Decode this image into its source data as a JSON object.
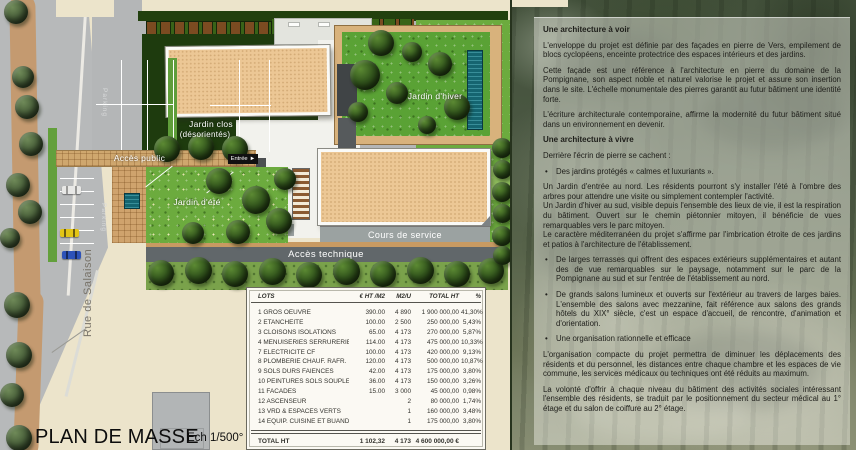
{
  "plan": {
    "title": "PLAN DE MASSE",
    "scale": "Ech 1/500°",
    "street": "Rue de Salaison",
    "labels": {
      "parking": "Parking",
      "acces_public": "Accès public",
      "entree": "Entrée",
      "jardin_clos_line1": "Jardin clos",
      "jardin_clos_line2": "(désorientés)",
      "jardin_hiver": "Jardin d'hiver",
      "jardin_ete": "Jardin d'été",
      "cours_service": "Cours de service",
      "acces_technique": "Accès technique"
    }
  },
  "icons": {
    "entree_arrow": "►",
    "bullet": "•"
  },
  "table": {
    "headers": [
      "LOTS",
      "€ HT /M2",
      "M2/U",
      "TOTAL HT",
      "%"
    ],
    "rows": [
      [
        "1 GROS OEUVRE",
        "390.00",
        "4 890",
        "1 900 000,00",
        "41,30%"
      ],
      [
        "2 ETANCHEITE",
        "100.00",
        "2 500",
        "250 000,00",
        "5,43%"
      ],
      [
        "3 CLOISONS ISOLATIONS",
        "65.00",
        "4 173",
        "270 000,00",
        "5,87%"
      ],
      [
        "4 MENUISERIES SERRURERIE",
        "114.00",
        "4 173",
        "475 000,00",
        "10,33%"
      ],
      [
        "7 ELECTRICITE CF",
        "100.00",
        "4 173",
        "420 000,00",
        "9,13%"
      ],
      [
        "8 PLOMBERIE CHAUF. RAFR.",
        "120.00",
        "4 173",
        "500 000,00",
        "10,87%"
      ],
      [
        "9 SOLS DURS FAIENCES",
        "42.00",
        "4 173",
        "175 000,00",
        "3,80%"
      ],
      [
        "10 PEINTURES SOLS SOUPLES",
        "36.00",
        "4 173",
        "150 000,00",
        "3,26%"
      ],
      [
        "11 FACADES",
        "15.00",
        "3 000",
        "45 000,00",
        "0,98%"
      ],
      [
        "12 ASCENSEUR",
        "",
        "2",
        "80 000,00",
        "1,74%"
      ],
      [
        "13 VRD & ESPACES VERTS",
        "",
        "1",
        "160 000,00",
        "3,48%"
      ],
      [
        "14 EQUIP. CUISINE ET BUANDERIE",
        "",
        "1",
        "175 000,00",
        "3,80%"
      ]
    ],
    "total": [
      "TOTAL HT",
      "1 102,32",
      "4 173",
      "4 600 000,00 €",
      ""
    ]
  },
  "panel": {
    "sections": [
      {
        "type": "heading",
        "text": "Une architecture à voir"
      },
      {
        "type": "para",
        "text": "L'enveloppe du projet est définie par des façades en pierre de Vers, empilement de blocs cyclopéens, enceinte protectrice des espaces intérieurs et des jardins."
      },
      {
        "type": "para",
        "text": "Cette façade est une référence à l'architecture en pierre du domaine de la Pompignane, son aspect noble et naturel valorise le projet et assure son insertion dans le site. L'échelle monumentale des pierres garantit au futur bâtiment une identité forte."
      },
      {
        "type": "para",
        "text": "L'écriture architecturale contemporaine, affirme la modernité du futur bâtiment situé dans un environnement en devenir."
      },
      {
        "type": "heading",
        "text": "Une architecture à vivre"
      },
      {
        "type": "para",
        "text": "Derrière l'écrin de pierre se cachent :"
      },
      {
        "type": "bullet",
        "text": "Des jardins protégés « calmes et luxuriants »."
      },
      {
        "type": "para0",
        "text": "Un Jardin d'entrée au nord. Les résidents pourront s'y installer l'été à l'ombre des arbres pour attendre une visite ou simplement contempler l'activité."
      },
      {
        "type": "para0",
        "text": "Un Jardin d'hiver au sud, visible depuis l'ensemble des lieux de vie, il est la respiration du bâtiment. Ouvert sur le chemin piétonnier mitoyen, il bénéficie de vues remarquables vers le parc mitoyen."
      },
      {
        "type": "para",
        "text": "Le caractère méditerranéen du projet s'affirme par l'imbrication étroite de ces jardins et patios à l'architecture de l'établissement."
      },
      {
        "type": "bullet",
        "text": "De larges terrasses qui offrent des espaces extérieurs supplémentaires et autant des de vue remarquables sur le paysage, notamment sur le parc de la Pompignane au sud et sur l'entrée de l'établissement au nord."
      },
      {
        "type": "bullet",
        "text": "De grands salons lumineux et ouverts sur l'extérieur au travers de larges baies. L'ensemble des salons avec mezzanine, fait référence aux salons des grands hôtels du XIX° siècle, c'est un espace d'accueil, de rencontre, d'animation et d'orientation."
      },
      {
        "type": "bullet",
        "text": "Une organisation rationnelle et efficace"
      },
      {
        "type": "para",
        "text": "L'organisation compacte du projet permettra de diminuer les déplacements des résidents et du personnel, les distances entre chaque chambre et les espaces de vie commune, les services médicaux ou techniques ont été réduits au maximum."
      },
      {
        "type": "para",
        "text": "La volonté d'offrir à chaque niveau du bâtiment des activités sociales intéressant l'ensemble des résidents, se traduit par le positionnement du secteur médical au 1° étage et du salon de coiffure au 2° étage."
      }
    ]
  },
  "colors": {
    "cream": "#ece4cb",
    "road": "#b7b9ba",
    "roof": "#ecc795",
    "lawn": "#6cab3e",
    "dark_garden": "#1e3b0e",
    "pool": "#156570",
    "tan_path": "#cfa76e",
    "photo_green": "#4a5742",
    "overlay": "rgba(242,241,234,0.46)"
  }
}
